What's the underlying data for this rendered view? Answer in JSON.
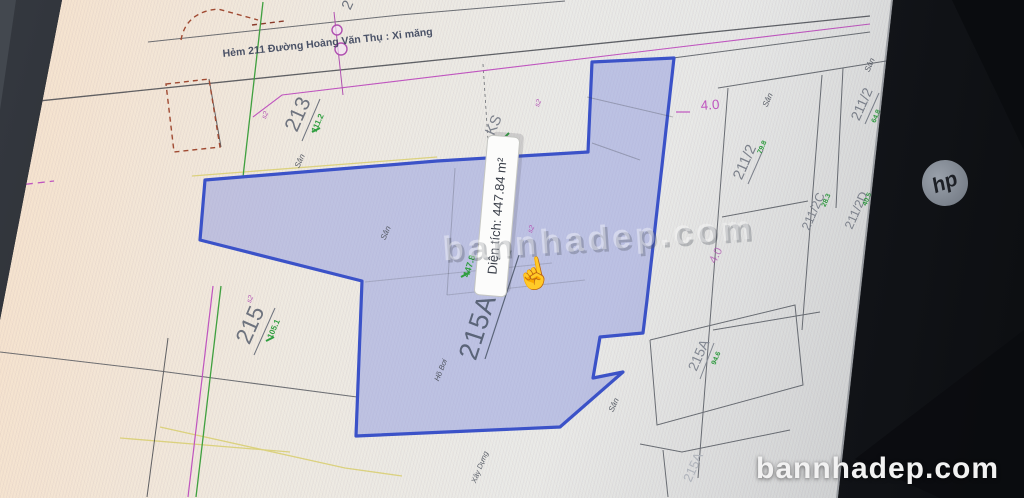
{
  "map": {
    "street_name": "Hẻm 211 Đường Hoàng Văn Thụ : Xi măng",
    "tooltip": "Diện tích: 447.84 m²",
    "cursor": "☝",
    "parcels": [
      {
        "id": "213",
        "area": "111.2"
      },
      {
        "id": "215",
        "area": "105.1"
      },
      {
        "id": "215AB+2",
        "area": "447.8"
      },
      {
        "id": "KS",
        "area": ""
      },
      {
        "id": "211/2",
        "area": "79.8"
      },
      {
        "id": "211/2",
        "area": "64.8"
      },
      {
        "id": "211/2C",
        "area": "28.3"
      },
      {
        "id": "211/2D",
        "area": "40.5"
      },
      {
        "id": "215A",
        "area": "94.6"
      },
      {
        "id": "215A",
        "area": ""
      },
      {
        "id": "2",
        "area": ""
      }
    ],
    "texts": {
      "san": "Sân",
      "ho_boi": "Hồ Bơi",
      "xay_dung": "Xây Dựng",
      "dim": "4.0",
      "mark": "s2"
    }
  },
  "watermark": {
    "center": "bannhadep.com",
    "corner": "bannhadep.com"
  },
  "monitor": {
    "brand": "hp"
  },
  "colors": {
    "highlight_fill": "#97a0e0",
    "highlight_stroke": "#3b52c8",
    "boundary_green": "#3fa03f",
    "boundary_magenta": "#bf55bf",
    "dashed_red": "#a04a32",
    "yellow_line": "#d8ce6e",
    "tooltip_bg": "#fcfcfb"
  }
}
